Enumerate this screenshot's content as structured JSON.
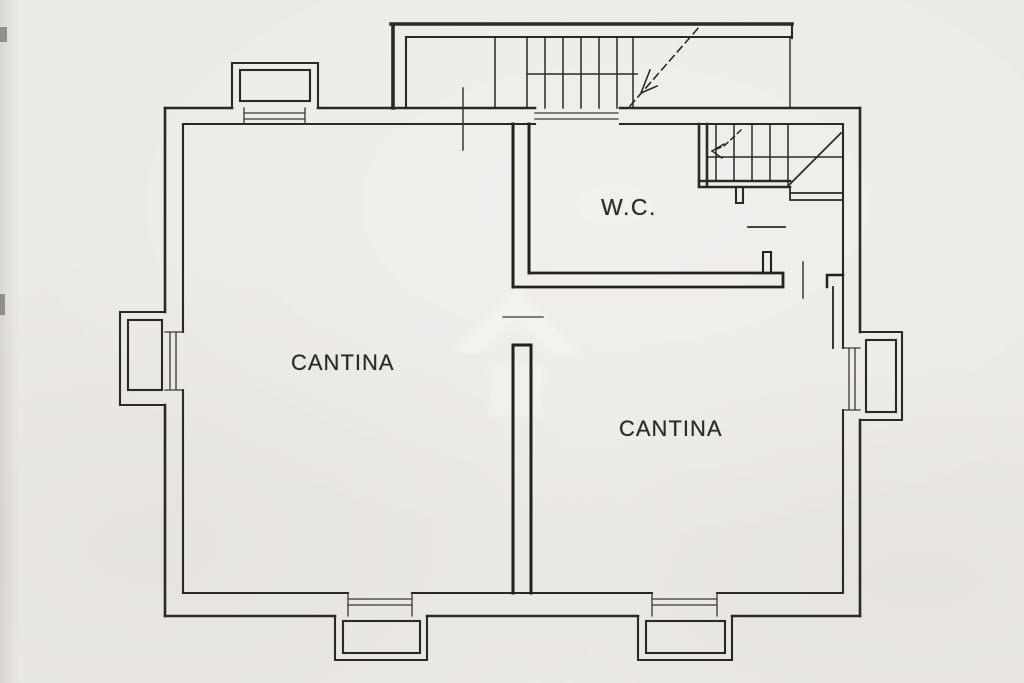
{
  "labels": {
    "cantina_left": "CANTINA",
    "cantina_right": "CANTINA",
    "wc": "W.C."
  },
  "colors": {
    "paper": "#ECEAE6",
    "ink": "#2B2925",
    "thin_line": "#3A3833",
    "watermark": "#F4F2EE"
  },
  "icons": {
    "stair_up_arrow": "dashed-diagonal-arrow",
    "stair_down_arrow": "dashed-turn-arrow"
  }
}
